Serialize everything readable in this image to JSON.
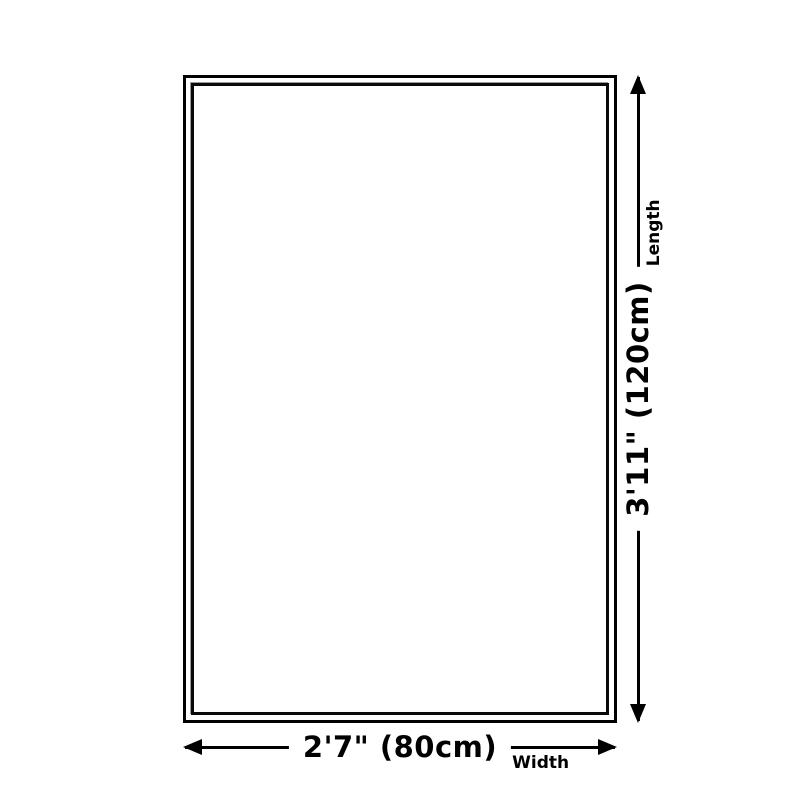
{
  "diagram": {
    "background_color": "#ffffff",
    "line_color": "#000000",
    "rug": {
      "outer_border_color": "#000000",
      "inner_border_color": "#0a0a0a"
    },
    "width_dim": {
      "size": "2'7\" (80cm)",
      "axis": "Width"
    },
    "length_dim": {
      "size": "3'11\" (120cm)",
      "axis": "Length"
    }
  }
}
